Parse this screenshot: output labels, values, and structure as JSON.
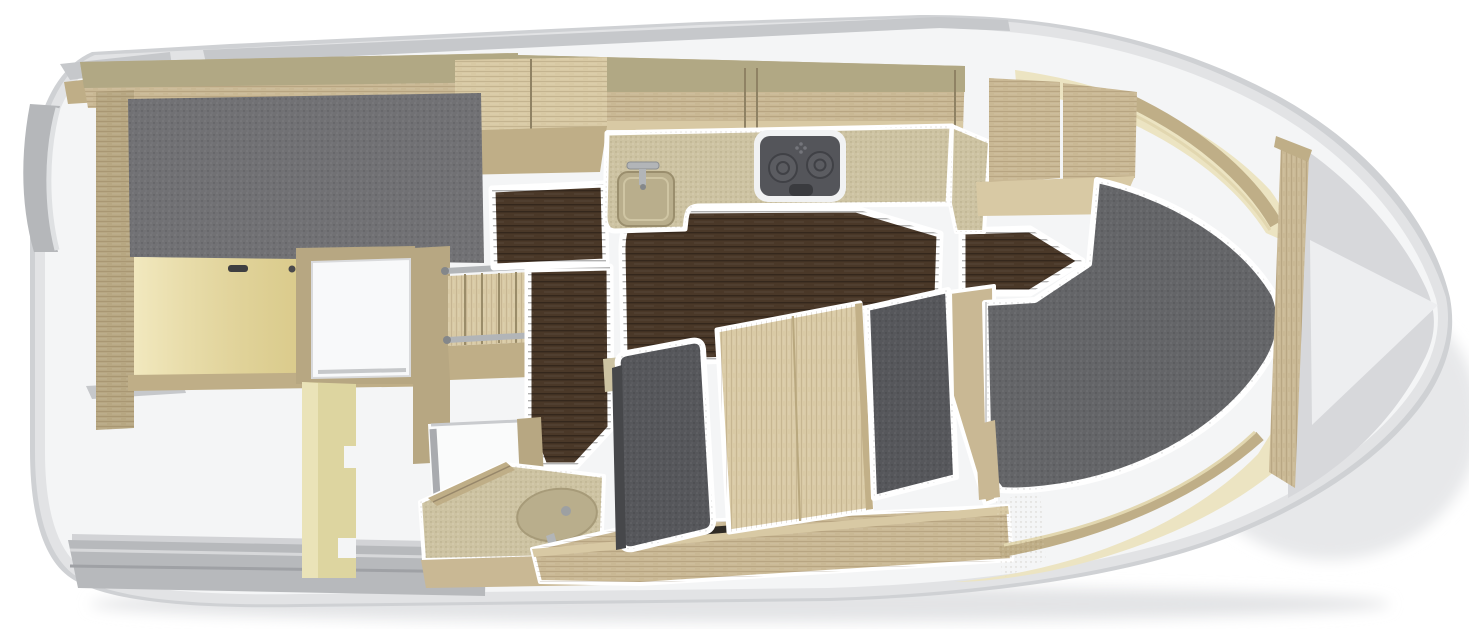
{
  "figure": {
    "subject": "motor-yacht interior floor plan",
    "view": "top-down cutaway 3D render",
    "bow_direction": "right",
    "visible_text": "none"
  },
  "regions": [
    {
      "name": "aft-cabin",
      "desc": "double berth with gray mattress and yellow bed base panel"
    },
    {
      "name": "wardrobe-locker",
      "desc": "white open locker with oak frame"
    },
    {
      "name": "companionway",
      "desc": "wooden steps with metal rails"
    },
    {
      "name": "galley",
      "desc": "speckled countertop with square sink, faucet and two-burner stove"
    },
    {
      "name": "saloon",
      "desc": "dark walnut floor areas"
    },
    {
      "name": "dinette",
      "desc": "gray upholstered seats with oak table and base"
    },
    {
      "name": "wet-bath",
      "desc": "oval sink, chrome faucet, shower tray"
    },
    {
      "name": "bow-cabin",
      "desc": "large gray V-berth mattress with cream hull lining"
    },
    {
      "name": "bow-stowage",
      "desc": "anchor locker area at bow tip"
    },
    {
      "name": "cockpit",
      "desc": "open white area with yellow partition"
    },
    {
      "name": "swim-platform",
      "desc": "gray stern deck strips"
    }
  ],
  "palette": {
    "page_bg": "#ffffff",
    "hull_rim": "#cfd1d4",
    "hull_fill": "#f4f5f6",
    "hull_edge_shade": "#e2e3e5",
    "bow_shade": "#d7d8db",
    "bow_highlight": "#edeef0",
    "deck_gray": "#c6c8cb",
    "platform_gray": "#b7b9bc",
    "platform_light": "#d2d3d6",
    "stern_gray": "#b5b7ba",
    "wood_olive": "#b1a884",
    "wood_oak": "#c9b894",
    "wood_oak_light": "#d8c9a4",
    "wood_oak_mid": "#bfae87",
    "wood_oak_deep": "#b7a782",
    "wood_table": "#d9caa5",
    "counter": "#cdc3a2",
    "counter_dark": "#b9ae8c",
    "walnut": "#4a3828",
    "mattress": "#717174",
    "berth": "#646568",
    "seat": "#56575b",
    "seat_edge": "#46474a",
    "yellow_panel": "#ecdfa3",
    "partition": "#ddd5a0",
    "partition_light": "#eae3b8",
    "cream": "#ece4c2",
    "trim_light": "#e2d7b0",
    "chrome": "#b2b5b8",
    "chrome_dark": "#8c8f92",
    "stove_body": "#54555a",
    "stove_rim": "#f1f2f3",
    "burner": "#5b5c61",
    "handle_dark": "#3f3f41",
    "vent_dark": "#2f2b25",
    "white_cut": "#ffffff"
  }
}
